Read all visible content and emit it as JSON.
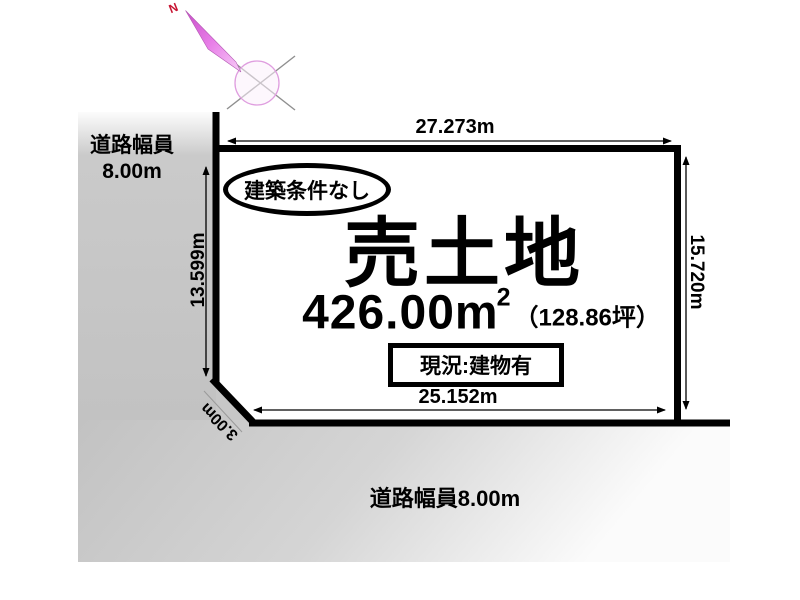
{
  "compass": {
    "north_label": "N"
  },
  "roads": {
    "left": {
      "label_line1": "道路幅員",
      "label_line2": "8.00m"
    },
    "bottom": {
      "label": "道路幅員8.00m"
    }
  },
  "plot": {
    "badge": "建築条件なし",
    "title": "売土地",
    "area_value": "426.00m",
    "area_sup": "2",
    "area_tsubo": "（128.86坪）",
    "status": "現況:建物有"
  },
  "dimensions": {
    "top": "27.273m",
    "left": "13.599m",
    "right": "15.720m",
    "bottom": "25.152m",
    "chamfer": "3.00m"
  },
  "colors": {
    "road_gray": "#c5c5c5",
    "boundary_black": "#000000",
    "compass_magenta": "#d24fd2",
    "compass_ring_pink": "#df9edf",
    "north_red": "#c81432"
  }
}
